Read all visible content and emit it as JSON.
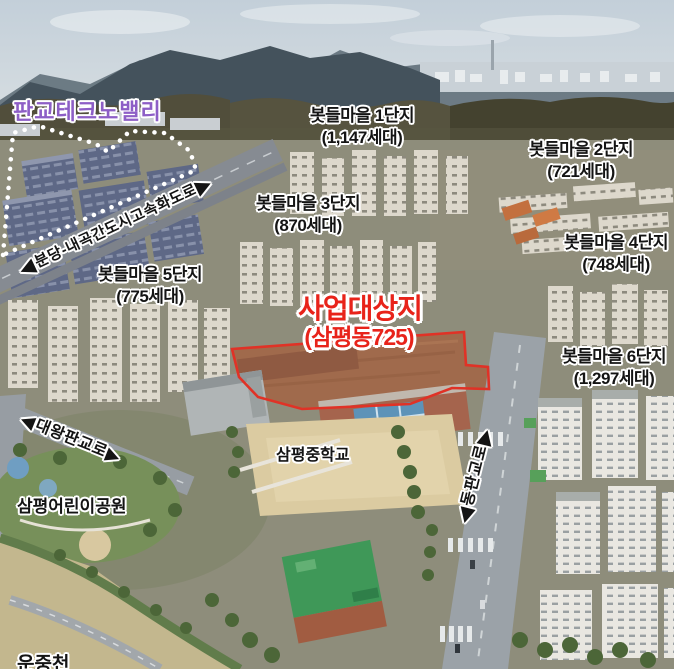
{
  "annotations": {
    "techno_valley": {
      "label": "판교테크노밸리"
    },
    "expressway": {
      "label": "분당-내곡간도시고속화도로"
    },
    "villages": [
      {
        "name": "봇들마을 1단지",
        "households": "(1,147세대)"
      },
      {
        "name": "봇들마을 2단지",
        "households": "(721세대)"
      },
      {
        "name": "봇들마을 3단지",
        "households": "(870세대)"
      },
      {
        "name": "봇들마을 4단지",
        "households": "(748세대)"
      },
      {
        "name": "봇들마을 5단지",
        "households": "(775세대)"
      },
      {
        "name": "봇들마을 6단지",
        "households": "(1,297세대)"
      }
    ],
    "site": {
      "title": "사업대상지",
      "subtitle": "(삼평동725)"
    },
    "middle_school": {
      "label": "삼평중학교"
    },
    "dongpangyo_road": {
      "label": "동판교로"
    },
    "daewangpangyo_road": {
      "label": "대왕판교로"
    },
    "children_park": {
      "label": "삼평어린이공원"
    },
    "stream": {
      "label": "운중천"
    }
  },
  "icons": {
    "arrow_left": "◀",
    "arrow_right": "▶"
  },
  "colors": {
    "village_label_text": "#141414",
    "label_outline": "#ffffff",
    "techno_valley_label_text": "#8d5ec6",
    "site_label_text": "#e8231a",
    "site_boundary": "#e03226",
    "techno_valley_boundary": "#ffffff"
  }
}
